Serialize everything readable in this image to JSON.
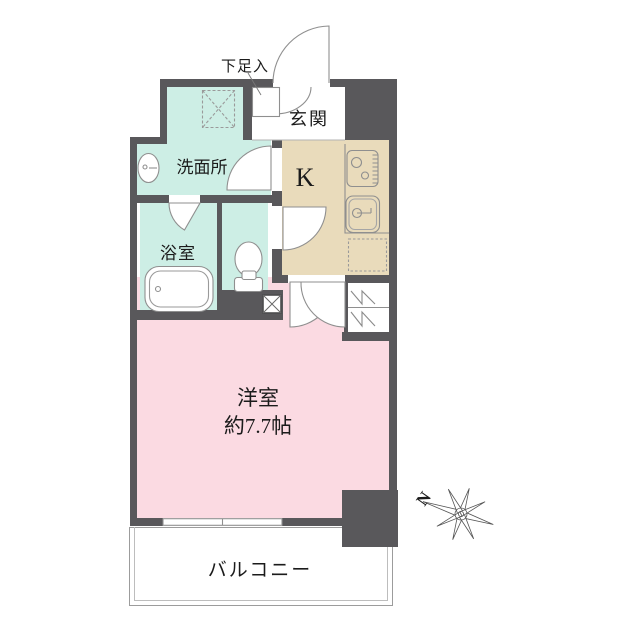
{
  "floorplan": {
    "labels": {
      "shoe_cabinet": "下足入",
      "entrance": "玄関",
      "washroom": "洗面所",
      "kitchen": "K",
      "bathroom": "浴室",
      "western_room_name": "洋室",
      "western_room_size": "約7.7帖",
      "balcony": "バルコニー",
      "compass_north": "N"
    },
    "colors": {
      "wall": "#59585b",
      "western_room": "#fbdae2",
      "wet_area": "#cdeee5",
      "kitchen": "#e9dbbb",
      "outline": "#8f8f8f"
    },
    "icons": {
      "washing_machine": "dashed-box-x",
      "washbasin": "oval-basin",
      "bathtub": "rounded-tub",
      "toilet": "bowl-and-tank",
      "stove": "two-burner",
      "kitchen_sink": "rounded-sink",
      "refrigerator_space": "dashed-box",
      "hanger_closet": "pole-zigzag",
      "pipe_space": "box-x",
      "compass": "eight-point-star"
    }
  }
}
